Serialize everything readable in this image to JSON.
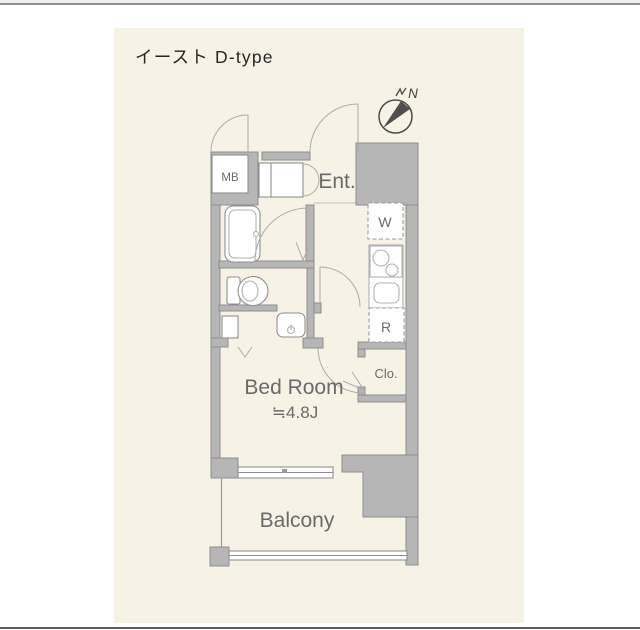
{
  "page": {
    "title": "イースト D-type"
  },
  "colors": {
    "panel_background": "#f7f2e6",
    "wall_fill": "#b6b6b6",
    "wall_edge": "#8d8d8d",
    "label_text": "#6a6a6a",
    "title_text": "#262626"
  },
  "compass": {
    "north_label": "N"
  },
  "labels": {
    "mb": "MB",
    "entrance": "Ent.",
    "washing_machine": "W",
    "refrigerator": "R",
    "closet": "Clo.",
    "bedroom_name": "Bed Room",
    "bedroom_area": "≒4.8J",
    "balcony": "Balcony"
  }
}
